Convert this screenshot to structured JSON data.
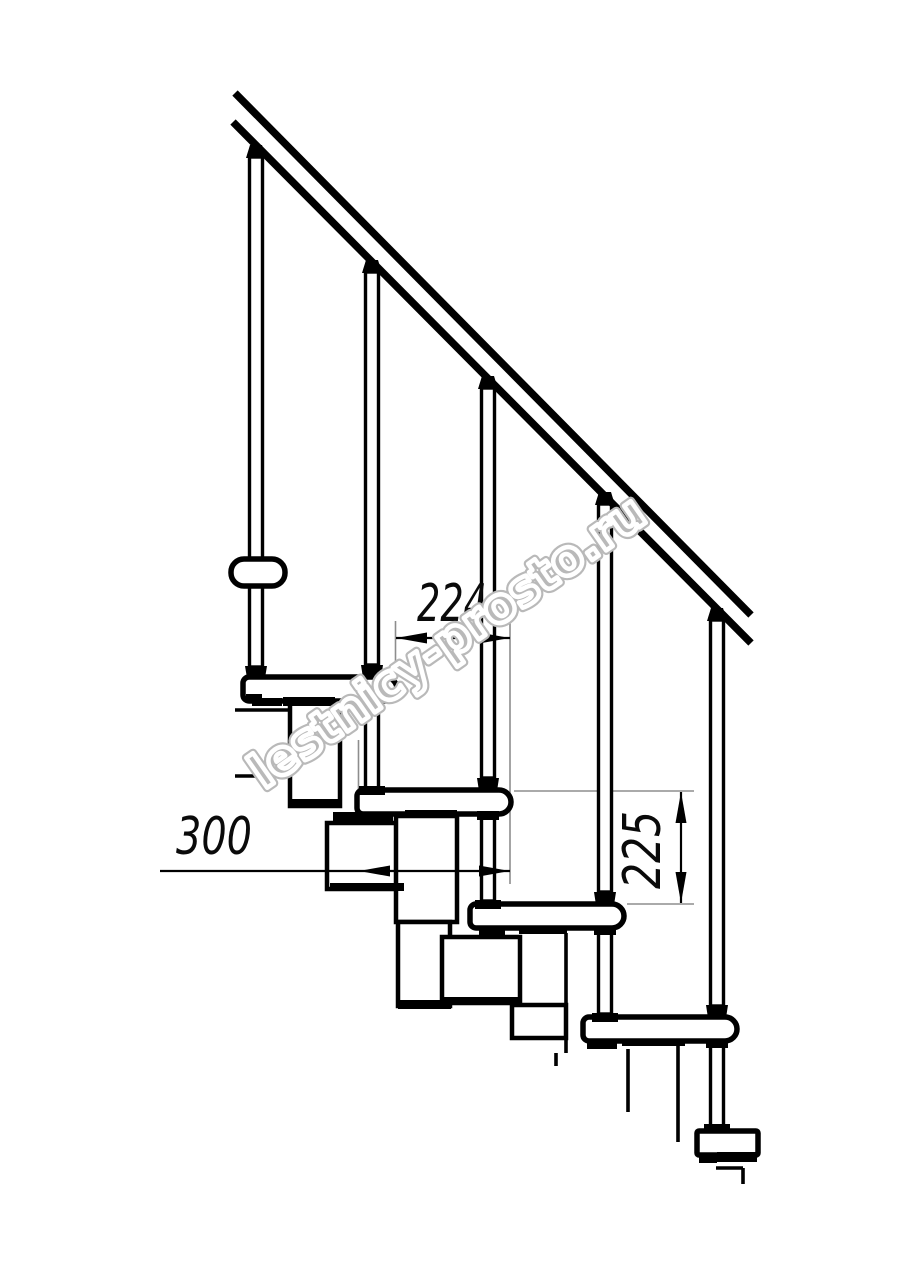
{
  "drawing": {
    "background": "#ffffff",
    "line_color": "#000000",
    "extension_line_color": "#8d8d8d",
    "dimensions": {
      "step_run": {
        "label": "224"
      },
      "tread_depth": {
        "label": "300"
      },
      "step_rise": {
        "label": "225"
      }
    },
    "watermark": {
      "text": "lestnicy-prosto.ru",
      "color": "#b9b9b9"
    }
  }
}
